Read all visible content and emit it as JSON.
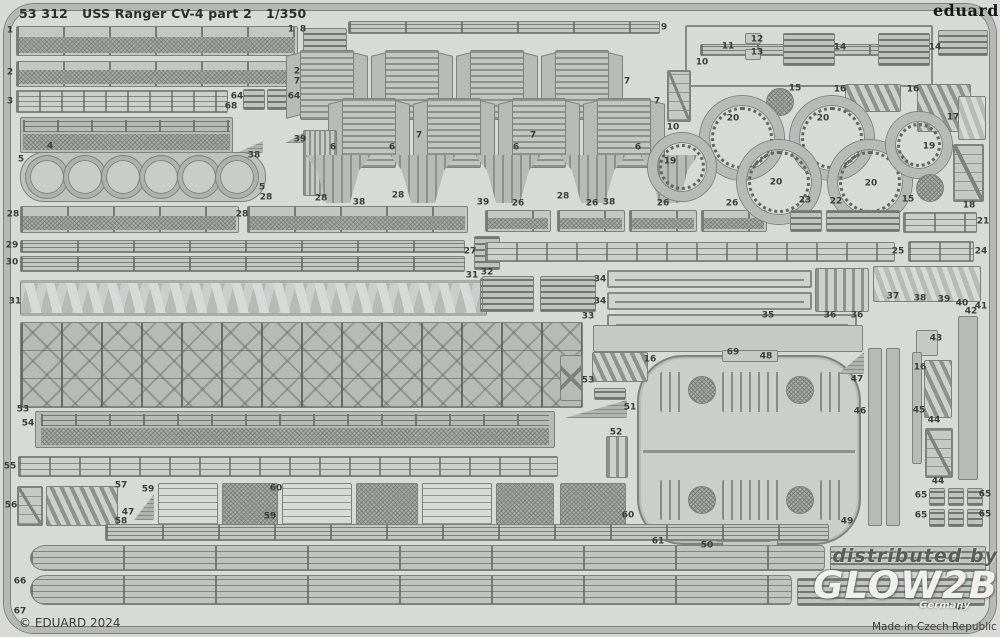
{
  "header": {
    "catalog": "53 312",
    "title": "USS Ranger CV-4 part 2",
    "scale": "1/350"
  },
  "brand": {
    "logo": "eduard"
  },
  "footer": {
    "copyright": "© EDUARD 2024",
    "made_in": "Made in Czech Republic"
  },
  "watermark": {
    "line1": "distributed by",
    "brand": "GLOW2B",
    "sub": "Germany"
  },
  "colors": {
    "sheet": "#d8dad6",
    "part": "#b7bbb7",
    "outline": "#7e827e",
    "label": "#3a3d3a",
    "watermark_light": "#fcfcfc"
  },
  "parts": [
    {
      "k": "railmesh",
      "x": 16,
      "y": 26,
      "w": 282,
      "h": 30
    },
    {
      "k": "grate",
      "x": 303,
      "y": 28,
      "w": 44,
      "h": 26
    },
    {
      "k": "railmesh",
      "x": 16,
      "y": 61,
      "w": 278,
      "h": 26
    },
    {
      "k": "railing2",
      "x": 16,
      "y": 90,
      "w": 212,
      "h": 23
    },
    {
      "k": "grate",
      "x": 243,
      "y": 89,
      "w": 22,
      "h": 21
    },
    {
      "k": "grate",
      "x": 267,
      "y": 89,
      "w": 22,
      "h": 21
    },
    {
      "k": "meshrail",
      "x": 20,
      "y": 117,
      "w": 213,
      "h": 36
    },
    {
      "k": "wedge",
      "x": 237,
      "y": 141,
      "w": 26,
      "h": 12
    },
    {
      "k": "wedge",
      "x": 285,
      "y": 131,
      "w": 22,
      "h": 12
    },
    {
      "k": "cstrip",
      "x": 20,
      "y": 152,
      "w": 246,
      "h": 50
    },
    {
      "k": "bigring",
      "x": 26,
      "y": 156,
      "w": 42,
      "h": 42
    },
    {
      "k": "bigring",
      "x": 64,
      "y": 156,
      "w": 42,
      "h": 42
    },
    {
      "k": "bigring",
      "x": 102,
      "y": 156,
      "w": 42,
      "h": 42
    },
    {
      "k": "bigring",
      "x": 140,
      "y": 156,
      "w": 42,
      "h": 42
    },
    {
      "k": "bigring",
      "x": 178,
      "y": 156,
      "w": 42,
      "h": 42
    },
    {
      "k": "bigring",
      "x": 216,
      "y": 156,
      "w": 42,
      "h": 42
    },
    {
      "k": "railmesh",
      "x": 20,
      "y": 206,
      "w": 219,
      "h": 27
    },
    {
      "k": "railmesh",
      "x": 247,
      "y": 206,
      "w": 221,
      "h": 27
    },
    {
      "k": "lines",
      "x": 20,
      "y": 240,
      "w": 445,
      "h": 13
    },
    {
      "k": "lines",
      "x": 20,
      "y": 256,
      "w": 445,
      "h": 16
    },
    {
      "k": "grate",
      "x": 474,
      "y": 236,
      "w": 26,
      "h": 34
    },
    {
      "k": "truss",
      "x": 20,
      "y": 280,
      "w": 467,
      "h": 36
    },
    {
      "k": "grate",
      "x": 480,
      "y": 278,
      "w": 20,
      "h": 34
    },
    {
      "k": "girder",
      "x": 20,
      "y": 322,
      "w": 563,
      "h": 86
    },
    {
      "k": "lines",
      "x": 348,
      "y": 21,
      "w": 312,
      "h": 13
    },
    {
      "k": "louver",
      "x": 300,
      "y": 50,
      "w": 54,
      "h": 70
    },
    {
      "k": "louver",
      "x": 385,
      "y": 50,
      "w": 54,
      "h": 70
    },
    {
      "k": "louver",
      "x": 470,
      "y": 50,
      "w": 54,
      "h": 70
    },
    {
      "k": "louver",
      "x": 555,
      "y": 50,
      "w": 54,
      "h": 70
    },
    {
      "k": "louver",
      "x": 342,
      "y": 98,
      "w": 54,
      "h": 70
    },
    {
      "k": "louver",
      "x": 427,
      "y": 98,
      "w": 54,
      "h": 70
    },
    {
      "k": "louver",
      "x": 512,
      "y": 98,
      "w": 54,
      "h": 70
    },
    {
      "k": "louver",
      "x": 597,
      "y": 98,
      "w": 54,
      "h": 70
    },
    {
      "k": "vlines",
      "x": 303,
      "y": 130,
      "w": 34,
      "h": 66
    },
    {
      "k": "bracket",
      "x": 305,
      "y": 155,
      "w": 66,
      "h": 48
    },
    {
      "k": "bracket",
      "x": 390,
      "y": 155,
      "w": 66,
      "h": 48
    },
    {
      "k": "bracket",
      "x": 475,
      "y": 155,
      "w": 66,
      "h": 48
    },
    {
      "k": "bracket",
      "x": 560,
      "y": 155,
      "w": 66,
      "h": 48
    },
    {
      "k": "bracket",
      "x": 640,
      "y": 155,
      "w": 58,
      "h": 48
    },
    {
      "k": "railmesh",
      "x": 485,
      "y": 210,
      "w": 66,
      "h": 22
    },
    {
      "k": "railmesh",
      "x": 557,
      "y": 210,
      "w": 68,
      "h": 22
    },
    {
      "k": "railmesh",
      "x": 629,
      "y": 210,
      "w": 68,
      "h": 22
    },
    {
      "k": "railmesh",
      "x": 701,
      "y": 210,
      "w": 66,
      "h": 22
    },
    {
      "k": "framebar",
      "x": 685,
      "y": 25,
      "w": 248,
      "h": 62
    },
    {
      "k": "lines",
      "x": 700,
      "y": 44,
      "w": 218,
      "h": 12
    },
    {
      "k": "grate",
      "x": 783,
      "y": 33,
      "w": 52,
      "h": 33
    },
    {
      "k": "grate",
      "x": 878,
      "y": 33,
      "w": 52,
      "h": 33
    },
    {
      "k": "plate",
      "x": 745,
      "y": 33,
      "w": 16,
      "h": 11
    },
    {
      "k": "plate",
      "x": 745,
      "y": 49,
      "w": 16,
      "h": 11
    },
    {
      "k": "grate",
      "x": 938,
      "y": 30,
      "w": 50,
      "h": 26
    },
    {
      "k": "ladder",
      "x": 667,
      "y": 70,
      "w": 24,
      "h": 52
    },
    {
      "k": "disch",
      "x": 766,
      "y": 88,
      "w": 28,
      "h": 28
    },
    {
      "k": "comb",
      "x": 845,
      "y": 84,
      "w": 56,
      "h": 28
    },
    {
      "k": "comb",
      "x": 917,
      "y": 84,
      "w": 54,
      "h": 48
    },
    {
      "k": "zigzag",
      "x": 958,
      "y": 96,
      "w": 28,
      "h": 44
    },
    {
      "k": "ring",
      "x": 700,
      "y": 96,
      "w": 84,
      "h": 84
    },
    {
      "k": "ring",
      "x": 790,
      "y": 96,
      "w": 84,
      "h": 84
    },
    {
      "k": "ring",
      "x": 737,
      "y": 140,
      "w": 84,
      "h": 84
    },
    {
      "k": "ring",
      "x": 828,
      "y": 140,
      "w": 84,
      "h": 84
    },
    {
      "k": "ring",
      "x": 648,
      "y": 133,
      "w": 68,
      "h": 68
    },
    {
      "k": "ring",
      "x": 886,
      "y": 112,
      "w": 66,
      "h": 66
    },
    {
      "k": "disch",
      "x": 916,
      "y": 174,
      "w": 28,
      "h": 28
    },
    {
      "k": "ladder",
      "x": 953,
      "y": 144,
      "w": 31,
      "h": 58
    },
    {
      "k": "grate",
      "x": 790,
      "y": 210,
      "w": 32,
      "h": 22
    },
    {
      "k": "grate",
      "x": 826,
      "y": 210,
      "w": 74,
      "h": 22
    },
    {
      "k": "railing",
      "x": 903,
      "y": 212,
      "w": 74,
      "h": 21
    },
    {
      "k": "railing",
      "x": 485,
      "y": 242,
      "w": 410,
      "h": 20
    },
    {
      "k": "railing",
      "x": 908,
      "y": 241,
      "w": 66,
      "h": 21
    },
    {
      "k": "grate",
      "x": 482,
      "y": 276,
      "w": 52,
      "h": 36
    },
    {
      "k": "grate",
      "x": 540,
      "y": 276,
      "w": 56,
      "h": 36
    },
    {
      "k": "oframe",
      "x": 607,
      "y": 270,
      "w": 205,
      "h": 18
    },
    {
      "k": "oframe",
      "x": 607,
      "y": 292,
      "w": 205,
      "h": 18
    },
    {
      "k": "oframe",
      "x": 607,
      "y": 314,
      "w": 250,
      "h": 20
    },
    {
      "k": "vslats",
      "x": 815,
      "y": 268,
      "w": 54,
      "h": 44
    },
    {
      "k": "zigzag",
      "x": 873,
      "y": 266,
      "w": 108,
      "h": 36
    },
    {
      "k": "vbar",
      "x": 958,
      "y": 316,
      "w": 20,
      "h": 164
    },
    {
      "k": "plate",
      "x": 916,
      "y": 330,
      "w": 22,
      "h": 26
    },
    {
      "k": "plate",
      "x": 593,
      "y": 325,
      "w": 270,
      "h": 27
    },
    {
      "k": "cap",
      "x": 637,
      "y": 355,
      "w": 224,
      "h": 190
    },
    {
      "k": "plate",
      "x": 722,
      "y": 350,
      "w": 56,
      "h": 12
    },
    {
      "k": "plate",
      "x": 722,
      "y": 534,
      "w": 56,
      "h": 12
    },
    {
      "k": "slots",
      "x": 660,
      "y": 372,
      "w": 26,
      "h": 40
    },
    {
      "k": "slots",
      "x": 722,
      "y": 372,
      "w": 60,
      "h": 40
    },
    {
      "k": "slots",
      "x": 820,
      "y": 372,
      "w": 26,
      "h": 40
    },
    {
      "k": "slots",
      "x": 660,
      "y": 480,
      "w": 26,
      "h": 40
    },
    {
      "k": "slots",
      "x": 722,
      "y": 480,
      "w": 60,
      "h": 40
    },
    {
      "k": "slots",
      "x": 820,
      "y": 480,
      "w": 26,
      "h": 40
    },
    {
      "k": "disch",
      "x": 688,
      "y": 376,
      "w": 28,
      "h": 28
    },
    {
      "k": "disch",
      "x": 786,
      "y": 376,
      "w": 28,
      "h": 28
    },
    {
      "k": "disch",
      "x": 688,
      "y": 486,
      "w": 28,
      "h": 28
    },
    {
      "k": "disch",
      "x": 786,
      "y": 486,
      "w": 28,
      "h": 28
    },
    {
      "k": "wedge",
      "x": 838,
      "y": 352,
      "w": 26,
      "h": 22
    },
    {
      "k": "wedge",
      "x": 715,
      "y": 528,
      "w": 56,
      "h": 14
    },
    {
      "k": "vbar",
      "x": 868,
      "y": 348,
      "w": 14,
      "h": 178
    },
    {
      "k": "vbar",
      "x": 886,
      "y": 348,
      "w": 14,
      "h": 178
    },
    {
      "k": "vbar",
      "x": 912,
      "y": 352,
      "w": 10,
      "h": 112
    },
    {
      "k": "comb",
      "x": 924,
      "y": 360,
      "w": 28,
      "h": 58
    },
    {
      "k": "ladder",
      "x": 925,
      "y": 428,
      "w": 28,
      "h": 50
    },
    {
      "k": "grate",
      "x": 929,
      "y": 488,
      "w": 16,
      "h": 18
    },
    {
      "k": "grate",
      "x": 948,
      "y": 488,
      "w": 16,
      "h": 18
    },
    {
      "k": "grate",
      "x": 967,
      "y": 488,
      "w": 16,
      "h": 18
    },
    {
      "k": "grate",
      "x": 929,
      "y": 509,
      "w": 16,
      "h": 18
    },
    {
      "k": "grate",
      "x": 948,
      "y": 509,
      "w": 16,
      "h": 18
    },
    {
      "k": "grate",
      "x": 967,
      "y": 509,
      "w": 16,
      "h": 18
    },
    {
      "k": "meshrail",
      "x": 35,
      "y": 411,
      "w": 520,
      "h": 37
    },
    {
      "k": "railing",
      "x": 18,
      "y": 456,
      "w": 540,
      "h": 21
    },
    {
      "k": "ladder",
      "x": 17,
      "y": 486,
      "w": 26,
      "h": 40
    },
    {
      "k": "comb",
      "x": 46,
      "y": 486,
      "w": 72,
      "h": 40
    },
    {
      "k": "wedge",
      "x": 134,
      "y": 494,
      "w": 20,
      "h": 26
    },
    {
      "k": "platform",
      "x": 158,
      "y": 483,
      "w": 60,
      "h": 42
    },
    {
      "k": "platformmesh",
      "x": 222,
      "y": 483,
      "w": 56,
      "h": 42
    },
    {
      "k": "platform",
      "x": 282,
      "y": 483,
      "w": 70,
      "h": 42
    },
    {
      "k": "platformmesh",
      "x": 356,
      "y": 483,
      "w": 62,
      "h": 42
    },
    {
      "k": "platform",
      "x": 422,
      "y": 483,
      "w": 70,
      "h": 42
    },
    {
      "k": "platformmesh",
      "x": 496,
      "y": 483,
      "w": 58,
      "h": 42
    },
    {
      "k": "comb",
      "x": 592,
      "y": 352,
      "w": 56,
      "h": 30
    },
    {
      "k": "grate",
      "x": 594,
      "y": 388,
      "w": 32,
      "h": 12
    },
    {
      "k": "wedge",
      "x": 565,
      "y": 400,
      "w": 62,
      "h": 18
    },
    {
      "k": "vslats",
      "x": 606,
      "y": 436,
      "w": 22,
      "h": 42
    },
    {
      "k": "xpiece",
      "x": 560,
      "y": 355,
      "w": 22,
      "h": 46
    },
    {
      "k": "platformmesh",
      "x": 560,
      "y": 483,
      "w": 66,
      "h": 46
    },
    {
      "k": "lines",
      "x": 105,
      "y": 524,
      "w": 724,
      "h": 17
    },
    {
      "k": "striprd",
      "x": 30,
      "y": 545,
      "w": 795,
      "h": 26
    },
    {
      "k": "grate",
      "x": 830,
      "y": 546,
      "w": 156,
      "h": 26
    },
    {
      "k": "striprd",
      "x": 30,
      "y": 575,
      "w": 762,
      "h": 30
    },
    {
      "k": "grate",
      "x": 797,
      "y": 578,
      "w": 188,
      "h": 28
    }
  ],
  "labels": [
    {
      "t": "1",
      "x": 10,
      "y": 31
    },
    {
      "t": "1",
      "x": 291,
      "y": 30
    },
    {
      "t": "8",
      "x": 303,
      "y": 30
    },
    {
      "t": "2",
      "x": 10,
      "y": 73
    },
    {
      "t": "2",
      "x": 297,
      "y": 72
    },
    {
      "t": "3",
      "x": 10,
      "y": 102
    },
    {
      "t": "64",
      "x": 237,
      "y": 97
    },
    {
      "t": "64",
      "x": 294,
      "y": 97
    },
    {
      "t": "68",
      "x": 231,
      "y": 107
    },
    {
      "t": "4",
      "x": 50,
      "y": 147
    },
    {
      "t": "38",
      "x": 254,
      "y": 156
    },
    {
      "t": "39",
      "x": 300,
      "y": 140
    },
    {
      "t": "5",
      "x": 21,
      "y": 160
    },
    {
      "t": "5",
      "x": 262,
      "y": 188
    },
    {
      "t": "28",
      "x": 13,
      "y": 215
    },
    {
      "t": "28",
      "x": 242,
      "y": 215
    },
    {
      "t": "28",
      "x": 266,
      "y": 198
    },
    {
      "t": "28",
      "x": 321,
      "y": 199
    },
    {
      "t": "28",
      "x": 398,
      "y": 196
    },
    {
      "t": "28",
      "x": 563,
      "y": 197
    },
    {
      "t": "26",
      "x": 518,
      "y": 204
    },
    {
      "t": "26",
      "x": 592,
      "y": 204
    },
    {
      "t": "26",
      "x": 663,
      "y": 204
    },
    {
      "t": "26",
      "x": 732,
      "y": 204
    },
    {
      "t": "6",
      "x": 333,
      "y": 148
    },
    {
      "t": "6",
      "x": 392,
      "y": 148
    },
    {
      "t": "6",
      "x": 516,
      "y": 148
    },
    {
      "t": "6",
      "x": 638,
      "y": 148
    },
    {
      "t": "38",
      "x": 359,
      "y": 203
    },
    {
      "t": "39",
      "x": 483,
      "y": 203
    },
    {
      "t": "38",
      "x": 609,
      "y": 203
    },
    {
      "t": "7",
      "x": 297,
      "y": 82
    },
    {
      "t": "7",
      "x": 627,
      "y": 82
    },
    {
      "t": "7",
      "x": 419,
      "y": 136
    },
    {
      "t": "7",
      "x": 533,
      "y": 136
    },
    {
      "t": "7",
      "x": 657,
      "y": 102
    },
    {
      "t": "9",
      "x": 664,
      "y": 28
    },
    {
      "t": "10",
      "x": 702,
      "y": 63
    },
    {
      "t": "10",
      "x": 673,
      "y": 128
    },
    {
      "t": "11",
      "x": 728,
      "y": 47
    },
    {
      "t": "12",
      "x": 757,
      "y": 40
    },
    {
      "t": "13",
      "x": 757,
      "y": 53
    },
    {
      "t": "14",
      "x": 840,
      "y": 48
    },
    {
      "t": "14",
      "x": 935,
      "y": 48
    },
    {
      "t": "15",
      "x": 795,
      "y": 89
    },
    {
      "t": "15",
      "x": 908,
      "y": 200
    },
    {
      "t": "16",
      "x": 840,
      "y": 90
    },
    {
      "t": "16",
      "x": 913,
      "y": 90
    },
    {
      "t": "16",
      "x": 650,
      "y": 360
    },
    {
      "t": "16",
      "x": 920,
      "y": 368
    },
    {
      "t": "17",
      "x": 953,
      "y": 118
    },
    {
      "t": "18",
      "x": 969,
      "y": 206
    },
    {
      "t": "19",
      "x": 670,
      "y": 162
    },
    {
      "t": "19",
      "x": 929,
      "y": 147
    },
    {
      "t": "20",
      "x": 733,
      "y": 119
    },
    {
      "t": "20",
      "x": 823,
      "y": 119
    },
    {
      "t": "20",
      "x": 776,
      "y": 183
    },
    {
      "t": "20",
      "x": 871,
      "y": 184
    },
    {
      "t": "21",
      "x": 983,
      "y": 222
    },
    {
      "t": "22",
      "x": 836,
      "y": 202
    },
    {
      "t": "23",
      "x": 805,
      "y": 201
    },
    {
      "t": "24",
      "x": 981,
      "y": 252
    },
    {
      "t": "25",
      "x": 898,
      "y": 252
    },
    {
      "t": "27",
      "x": 470,
      "y": 252
    },
    {
      "t": "29",
      "x": 12,
      "y": 246
    },
    {
      "t": "30",
      "x": 12,
      "y": 263
    },
    {
      "t": "31",
      "x": 15,
      "y": 302
    },
    {
      "t": "31",
      "x": 472,
      "y": 276
    },
    {
      "t": "32",
      "x": 487,
      "y": 273
    },
    {
      "t": "33",
      "x": 588,
      "y": 317
    },
    {
      "t": "34",
      "x": 600,
      "y": 280
    },
    {
      "t": "34",
      "x": 600,
      "y": 302
    },
    {
      "t": "35",
      "x": 768,
      "y": 316
    },
    {
      "t": "36",
      "x": 830,
      "y": 316
    },
    {
      "t": "36",
      "x": 857,
      "y": 316
    },
    {
      "t": "37",
      "x": 893,
      "y": 297
    },
    {
      "t": "38",
      "x": 920,
      "y": 299
    },
    {
      "t": "39",
      "x": 944,
      "y": 300
    },
    {
      "t": "40",
      "x": 962,
      "y": 304
    },
    {
      "t": "41",
      "x": 981,
      "y": 307
    },
    {
      "t": "42",
      "x": 971,
      "y": 312
    },
    {
      "t": "43",
      "x": 936,
      "y": 339
    },
    {
      "t": "44",
      "x": 934,
      "y": 421
    },
    {
      "t": "44",
      "x": 938,
      "y": 482
    },
    {
      "t": "45",
      "x": 919,
      "y": 411
    },
    {
      "t": "46",
      "x": 860,
      "y": 412
    },
    {
      "t": "47",
      "x": 857,
      "y": 380
    },
    {
      "t": "47",
      "x": 128,
      "y": 513
    },
    {
      "t": "48",
      "x": 766,
      "y": 357
    },
    {
      "t": "49",
      "x": 847,
      "y": 522
    },
    {
      "t": "50",
      "x": 707,
      "y": 546
    },
    {
      "t": "51",
      "x": 630,
      "y": 408
    },
    {
      "t": "52",
      "x": 616,
      "y": 433
    },
    {
      "t": "53",
      "x": 23,
      "y": 410
    },
    {
      "t": "53",
      "x": 588,
      "y": 381
    },
    {
      "t": "54",
      "x": 28,
      "y": 424
    },
    {
      "t": "55",
      "x": 10,
      "y": 467
    },
    {
      "t": "56",
      "x": 11,
      "y": 506
    },
    {
      "t": "57",
      "x": 121,
      "y": 486
    },
    {
      "t": "58",
      "x": 121,
      "y": 522
    },
    {
      "t": "59",
      "x": 148,
      "y": 490
    },
    {
      "t": "59",
      "x": 270,
      "y": 517
    },
    {
      "t": "60",
      "x": 276,
      "y": 489
    },
    {
      "t": "60",
      "x": 628,
      "y": 516
    },
    {
      "t": "61",
      "x": 658,
      "y": 542
    },
    {
      "t": "65",
      "x": 921,
      "y": 496
    },
    {
      "t": "65",
      "x": 985,
      "y": 495
    },
    {
      "t": "65",
      "x": 921,
      "y": 516
    },
    {
      "t": "65",
      "x": 985,
      "y": 515
    },
    {
      "t": "66",
      "x": 20,
      "y": 582
    },
    {
      "t": "67",
      "x": 20,
      "y": 612
    },
    {
      "t": "40",
      "x": 961,
      "y": 608
    },
    {
      "t": "69",
      "x": 733,
      "y": 353
    }
  ]
}
